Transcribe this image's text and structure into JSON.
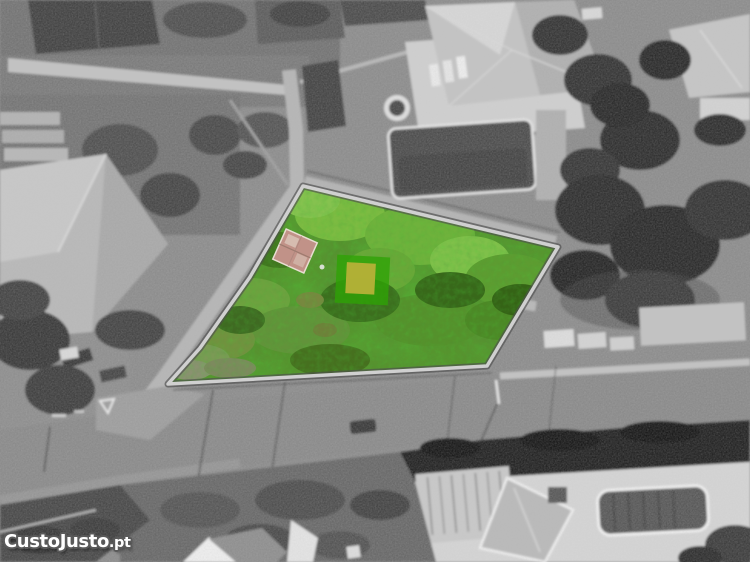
{
  "image": {
    "kind": "aerial photograph of a land plot for sale",
    "style": "grayscale aerial photo with the plot for sale highlighted in green colour",
    "width": 750,
    "height": 562
  },
  "watermark": {
    "brand": "CustoJusto",
    "suffix": ".pt",
    "full": "CustoJusto.pt",
    "text_color": "#ffffff",
    "outline_color": "#5a5a5a"
  },
  "parcel": {
    "label": "highlighted plot of land",
    "fill_green": "#57922e",
    "border_light": "#d0d0d0",
    "border_shadow": "#4f4f4f",
    "marker_green": "#2ea305",
    "marker_yellow": "#b6b138",
    "ruin_roof_pink": "#c19288",
    "vertices_px": [
      [
        303,
        186
      ],
      [
        558,
        247
      ],
      [
        487,
        366
      ],
      [
        168,
        384
      ],
      [
        200,
        348
      ],
      [
        250,
        277
      ]
    ]
  },
  "surroundings": {
    "road_gray": "#8b8b8b",
    "sidewalk_gray": "#c2c2c2",
    "dark_roof": "#474747",
    "light_roof": "#c3c3c3",
    "tree_dark": "#333333",
    "hedge_dark": "#262626",
    "terrace_white": "#d4d4d4",
    "pool_water": "#4f4f4f"
  }
}
